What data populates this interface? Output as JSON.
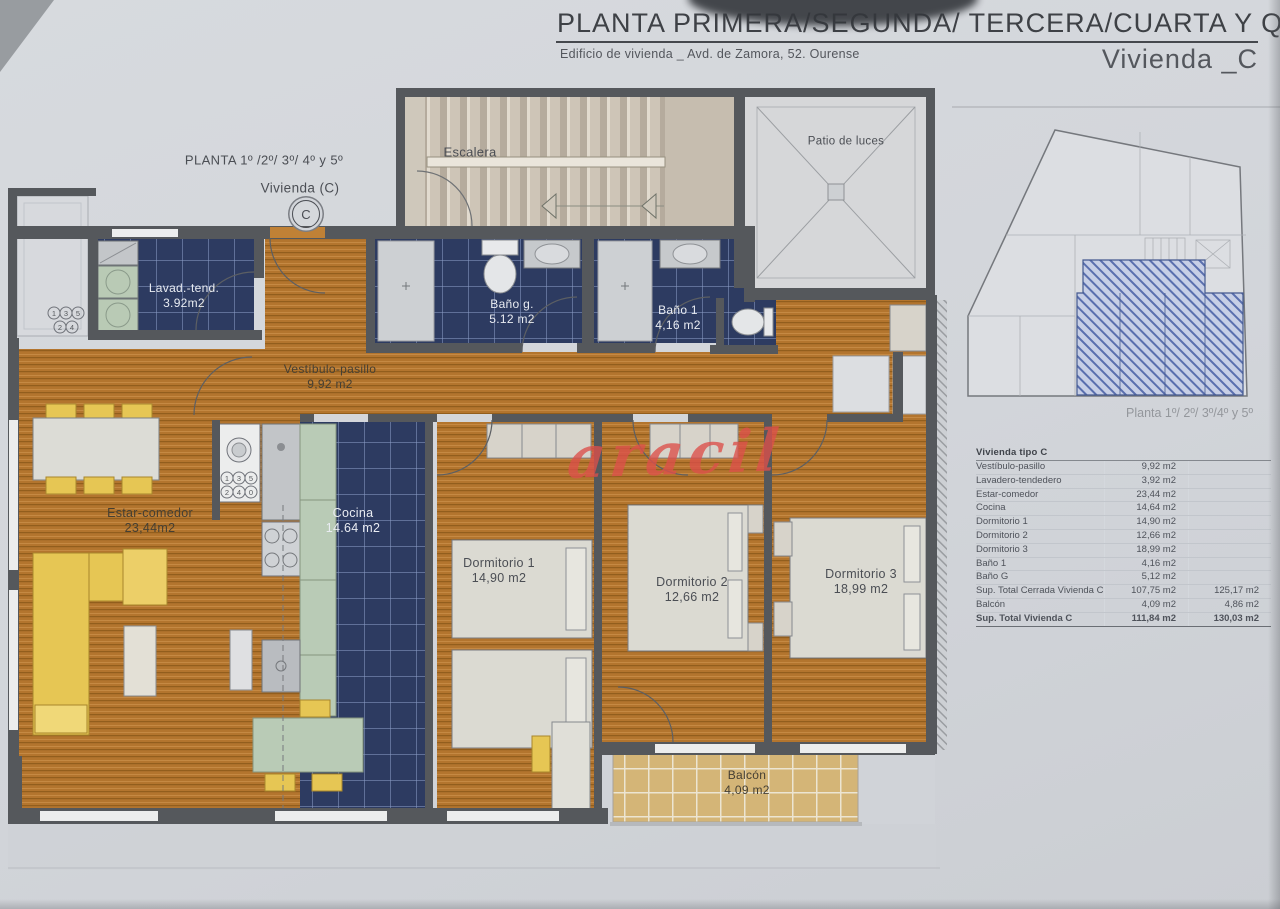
{
  "header": {
    "title": "PLANTA PRIMERA/SEGUNDA/ TERCERA/CUARTA Y QUINTA",
    "subtitle": "Edificio de vivienda _ Avd. de Zamora, 52. Ourense",
    "unit": "Vivienda _C"
  },
  "plan_note": {
    "line1": "PLANTA 1º /2º/ 3º/ 4º y 5º",
    "line2": "Vivienda  (C)",
    "badge": "C"
  },
  "rooms": {
    "escalera": {
      "name": "Escalera"
    },
    "patio": {
      "name": "Patio de luces"
    },
    "lavadero": {
      "name": "Lavad.-tend.",
      "area": "3.92m2"
    },
    "bano_g": {
      "name": "Baño g.",
      "area": "5.12 m2"
    },
    "bano_1": {
      "name": "Baño 1",
      "area": "4,16 m2"
    },
    "vestibulo": {
      "name": "Vestíbulo-pasillo",
      "area": "9,92 m2"
    },
    "estar": {
      "name": "Estar-comedor",
      "area": "23,44m2"
    },
    "cocina": {
      "name": "Cocina",
      "area": "14.64 m2"
    },
    "dormitorio1": {
      "name": "Dormitorio 1",
      "area": "14,90 m2"
    },
    "dormitorio2": {
      "name": "Dormitorio 2",
      "area": "12,66 m2"
    },
    "dormitorio3": {
      "name": "Dormitorio 3",
      "area": "18,99 m2"
    },
    "balcon": {
      "name": "Balcón",
      "area": "4,09 m2"
    }
  },
  "dials": {
    "kitchen": [
      "1",
      "3",
      "5",
      "2",
      "4",
      "0"
    ],
    "exterior": [
      "1",
      "3",
      "5",
      "2",
      "4"
    ]
  },
  "watermark": "aracil",
  "overview": {
    "caption": "Planta 1º/ 2º/ 3º/4º y 5º"
  },
  "table": {
    "title": "Vivienda tipo C",
    "rows": [
      {
        "label": "Vestíbulo-pasillo",
        "v1": "9,92 m2",
        "v2": ""
      },
      {
        "label": "Lavadero-tendedero",
        "v1": "3,92 m2",
        "v2": ""
      },
      {
        "label": "Estar-comedor",
        "v1": "23,44 m2",
        "v2": ""
      },
      {
        "label": "Cocina",
        "v1": "14,64 m2",
        "v2": ""
      },
      {
        "label": "Dormitorio 1",
        "v1": "14,90 m2",
        "v2": ""
      },
      {
        "label": "Dormitorio 2",
        "v1": "12,66 m2",
        "v2": ""
      },
      {
        "label": "Dormitorio 3",
        "v1": "18,99 m2",
        "v2": ""
      },
      {
        "label": "Baño 1",
        "v1": "4,16 m2",
        "v2": ""
      },
      {
        "label": "Baño G",
        "v1": "5,12 m2",
        "v2": ""
      },
      {
        "label": "Sup. Total Cerrada Vivienda C",
        "v1": "107,75 m2",
        "v2": "125,17 m2"
      },
      {
        "label": "Balcón",
        "v1": "4,09 m2",
        "v2": "4,86 m2"
      },
      {
        "label": "Sup. Total Vivienda C",
        "v1": "111,84 m2",
        "v2": "130,03 m2"
      }
    ]
  },
  "colors": {
    "wood": "#b3752e",
    "tile_navy": "#2d3b61",
    "stair_beige": "#cfc8bb",
    "wall_gray": "#55585c",
    "accent_red": "#dd4f4a",
    "highlight_blue": "#44598f"
  }
}
